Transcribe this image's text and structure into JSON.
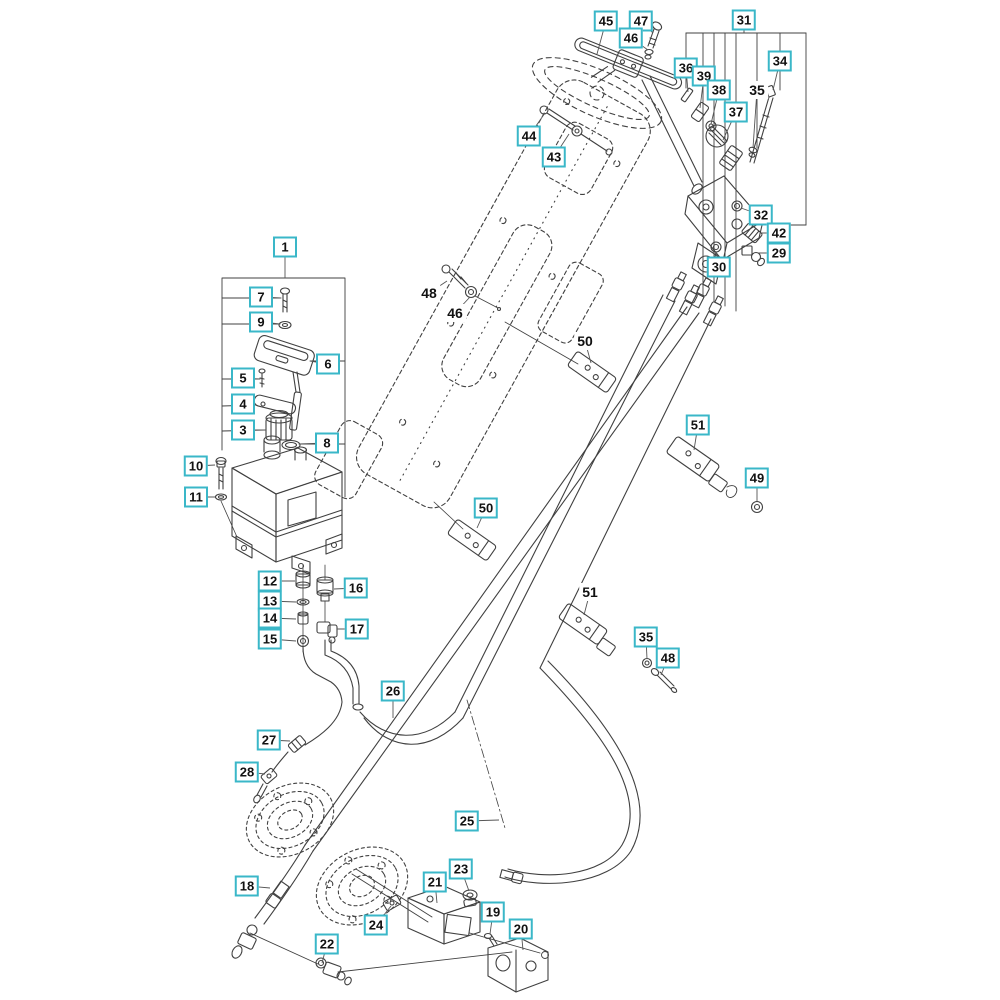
{
  "diagram": {
    "type": "exploded-parts-diagram",
    "subject": "steering system with hydraulic hoses, reservoir tank, steering wheel, valve and cylinder",
    "background": "#ffffff",
    "palette": {
      "label_border": "#3ab7c8",
      "label_bg": "#ffffff",
      "label_text": "#111111",
      "line": "#404040",
      "leader": "#555555"
    },
    "callouts": [
      {
        "text": "45",
        "x": 606,
        "y": 21,
        "boxed": true,
        "tx": 597,
        "ty": 54
      },
      {
        "text": "47",
        "x": 641,
        "y": 21,
        "boxed": true,
        "tx": 653,
        "ty": 33
      },
      {
        "text": "46",
        "x": 631,
        "y": 38,
        "boxed": true,
        "tx": 648,
        "ty": 50
      },
      {
        "text": "31",
        "x": 744,
        "y": 20,
        "boxed": true,
        "tx": 744,
        "ty": 33
      },
      {
        "text": "36",
        "x": 686,
        "y": 68,
        "boxed": true,
        "tx": 688,
        "ty": 92
      },
      {
        "text": "39",
        "x": 704,
        "y": 76,
        "boxed": true,
        "tx": 700,
        "ty": 108
      },
      {
        "text": "38",
        "x": 719,
        "y": 90,
        "boxed": true,
        "tx": 711,
        "ty": 124
      },
      {
        "text": "34",
        "x": 780,
        "y": 61,
        "boxed": true,
        "tx": 773,
        "ty": 90
      },
      {
        "text": "35",
        "x": 757,
        "y": 90,
        "boxed": false,
        "tx": 753,
        "ty": 148
      },
      {
        "text": "37",
        "x": 736,
        "y": 112,
        "boxed": true,
        "tx": 723,
        "ty": 140
      },
      {
        "text": "44",
        "x": 529,
        "y": 136,
        "boxed": true,
        "tx": 545,
        "ty": 113
      },
      {
        "text": "43",
        "x": 554,
        "y": 157,
        "boxed": true,
        "tx": 569,
        "ty": 134
      },
      {
        "text": "32",
        "x": 761,
        "y": 215,
        "boxed": true,
        "tx": 741,
        "ty": 208
      },
      {
        "text": "42",
        "x": 779,
        "y": 233,
        "boxed": true,
        "tx": 762,
        "ty": 233
      },
      {
        "text": "29",
        "x": 779,
        "y": 253,
        "boxed": true,
        "tx": 758,
        "ty": 253
      },
      {
        "text": "30",
        "x": 719,
        "y": 267,
        "boxed": true,
        "tx": 716,
        "ty": 252
      },
      {
        "text": "1",
        "x": 285,
        "y": 247,
        "boxed": true,
        "tx": 285,
        "ty": 278
      },
      {
        "text": "7",
        "x": 261,
        "y": 297,
        "boxed": true,
        "tx": 281,
        "ty": 298
      },
      {
        "text": "9",
        "x": 261,
        "y": 322,
        "boxed": true,
        "tx": 280,
        "ty": 324
      },
      {
        "text": "48",
        "x": 429,
        "y": 293,
        "boxed": false,
        "tx": 447,
        "ty": 281
      },
      {
        "text": "46",
        "x": 455,
        "y": 313,
        "boxed": false,
        "tx": 470,
        "ty": 297
      },
      {
        "text": "6",
        "x": 328,
        "y": 364,
        "boxed": true,
        "tx": 310,
        "ty": 361
      },
      {
        "text": "5",
        "x": 243,
        "y": 378,
        "boxed": true,
        "tx": 260,
        "ty": 379
      },
      {
        "text": "4",
        "x": 243,
        "y": 404,
        "boxed": true,
        "tx": 256,
        "ty": 405
      },
      {
        "text": "3",
        "x": 243,
        "y": 430,
        "boxed": true,
        "tx": 266,
        "ty": 430
      },
      {
        "text": "8",
        "x": 327,
        "y": 443,
        "boxed": true,
        "tx": 299,
        "ty": 444
      },
      {
        "text": "50",
        "x": 585,
        "y": 341,
        "boxed": false,
        "tx": 591,
        "ty": 363
      },
      {
        "text": "10",
        "x": 196,
        "y": 466,
        "boxed": true,
        "tx": 215,
        "ty": 465
      },
      {
        "text": "11",
        "x": 196,
        "y": 497,
        "boxed": true,
        "tx": 215,
        "ty": 497
      },
      {
        "text": "51",
        "x": 698,
        "y": 425,
        "boxed": true,
        "tx": 694,
        "ty": 450
      },
      {
        "text": "49",
        "x": 757,
        "y": 478,
        "boxed": true,
        "tx": 757,
        "ty": 501
      },
      {
        "text": "50",
        "x": 486,
        "y": 508,
        "boxed": true,
        "tx": 477,
        "ty": 528
      },
      {
        "text": "12",
        "x": 270,
        "y": 581,
        "boxed": true,
        "tx": 295,
        "ty": 581
      },
      {
        "text": "16",
        "x": 356,
        "y": 588,
        "boxed": true,
        "tx": 334,
        "ty": 589
      },
      {
        "text": "13",
        "x": 270,
        "y": 601,
        "boxed": true,
        "tx": 296,
        "ty": 602
      },
      {
        "text": "14",
        "x": 270,
        "y": 618,
        "boxed": true,
        "tx": 296,
        "ty": 619
      },
      {
        "text": "17",
        "x": 357,
        "y": 629,
        "boxed": true,
        "tx": 337,
        "ty": 629
      },
      {
        "text": "15",
        "x": 270,
        "y": 639,
        "boxed": true,
        "tx": 296,
        "ty": 641
      },
      {
        "text": "51",
        "x": 590,
        "y": 592,
        "boxed": false,
        "tx": 584,
        "ty": 615
      },
      {
        "text": "35",
        "x": 646,
        "y": 637,
        "boxed": true,
        "tx": 647,
        "ty": 659
      },
      {
        "text": "48",
        "x": 668,
        "y": 658,
        "boxed": true,
        "tx": 661,
        "ty": 675
      },
      {
        "text": "26",
        "x": 393,
        "y": 691,
        "boxed": true,
        "tx": 393,
        "ty": 718
      },
      {
        "text": "27",
        "x": 269,
        "y": 740,
        "boxed": true,
        "tx": 290,
        "ty": 741
      },
      {
        "text": "28",
        "x": 247,
        "y": 772,
        "boxed": true,
        "tx": 265,
        "ty": 774
      },
      {
        "text": "25",
        "x": 467,
        "y": 821,
        "boxed": true,
        "tx": 499,
        "ty": 820
      },
      {
        "text": "18",
        "x": 247,
        "y": 886,
        "boxed": true,
        "tx": 270,
        "ty": 888
      },
      {
        "text": "23",
        "x": 461,
        "y": 869,
        "boxed": true,
        "tx": 469,
        "ty": 891
      },
      {
        "text": "21",
        "x": 435,
        "y": 882,
        "boxed": true,
        "tx": 437,
        "ty": 903
      },
      {
        "text": "24",
        "x": 376,
        "y": 925,
        "boxed": true,
        "tx": 391,
        "ty": 906
      },
      {
        "text": "19",
        "x": 493,
        "y": 912,
        "boxed": true,
        "tx": 490,
        "ty": 934
      },
      {
        "text": "20",
        "x": 521,
        "y": 929,
        "boxed": true,
        "tx": 523,
        "ty": 950
      },
      {
        "text": "22",
        "x": 327,
        "y": 944,
        "boxed": true,
        "tx": 322,
        "ty": 963
      }
    ]
  }
}
